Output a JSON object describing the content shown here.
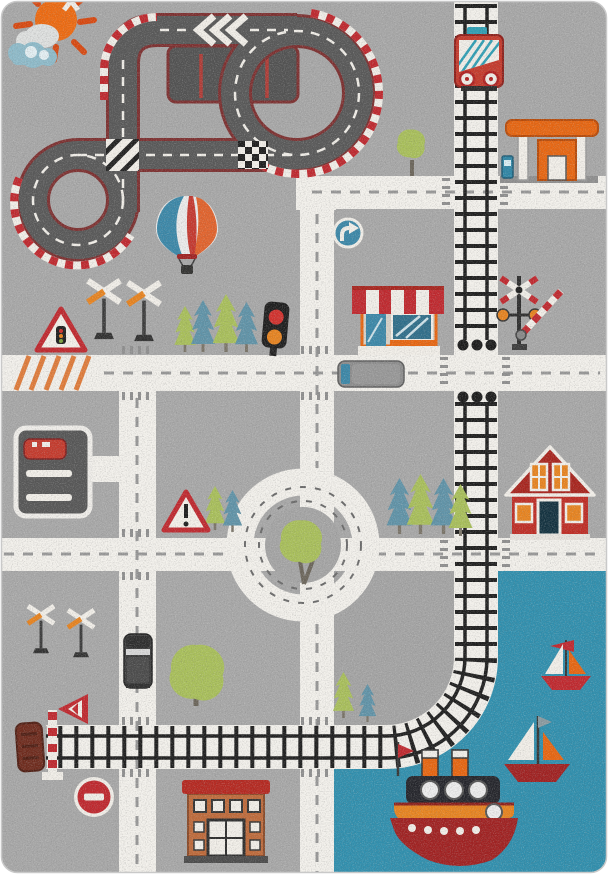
{
  "photo": {
    "subject": "kids city traffic play rug, top view product photo",
    "background": "plain white studio background"
  },
  "colors": {
    "rug": "#a8a8a8",
    "road": "#f3f1ec",
    "asphalt": "#585858",
    "edge": "#7d2f2f",
    "curb": "#c0272d",
    "rail": "#1d1d1d",
    "sea": "#2f8fae",
    "green": "#a9c05a",
    "teal": "#5f93a8",
    "orange": "#e8650f",
    "sigorange": "#e8831e",
    "red": "#c5392b",
    "darkred": "#a02020",
    "mark": "#979797",
    "white": "#f2efe9",
    "steel": "#3a87a8",
    "dark": "#222222",
    "brick": "#bf6a3a",
    "trunk": "#6b655a"
  },
  "labels": {
    "rug": "Children's city roads play rug",
    "sun": "Sun",
    "clouds": "Clouds",
    "race_track": "Race track loop with striped curbs",
    "pit_lane": "Pit lane parking bays",
    "balloon": "Hot air balloon",
    "train": "Red train engine",
    "railway": "Railway track",
    "gas_station": "Gas station",
    "roads": "White city roads",
    "roundabout": "Roundabout with tree island",
    "shop": "Shop with striped awning",
    "house": "Red house",
    "crossing_signal": "Level crossing signal with barrier",
    "crossbucks_upper": "Railway crossing signs",
    "crossbucks_lower": "Railway crossing signs",
    "traffic_light": "Traffic light",
    "warning_light_sign": "Traffic signals ahead sign",
    "warning_exclamation_sign": "Warning sign",
    "turn_right_sign": "Turn right sign",
    "no_entry_sign": "No entry sign",
    "parking": "Parking bay with red car",
    "red_car": "Red car",
    "bus": "Gray bus",
    "jeep": "Dark SUV",
    "big_tree": "Large tree",
    "trees": "Fir trees",
    "sea": "Harbour water",
    "steamboat": "Steamboat with funnels",
    "sailboat_small": "Small sailboat",
    "sailboat_large": "Sailboat",
    "school": "Brick building",
    "buffer_stop": "Railway buffer stop",
    "barrier_pole": "Striped barrier pole",
    "cone_sign": "Striped end-of-track sign",
    "hatch": "Orange hatched road marking"
  }
}
